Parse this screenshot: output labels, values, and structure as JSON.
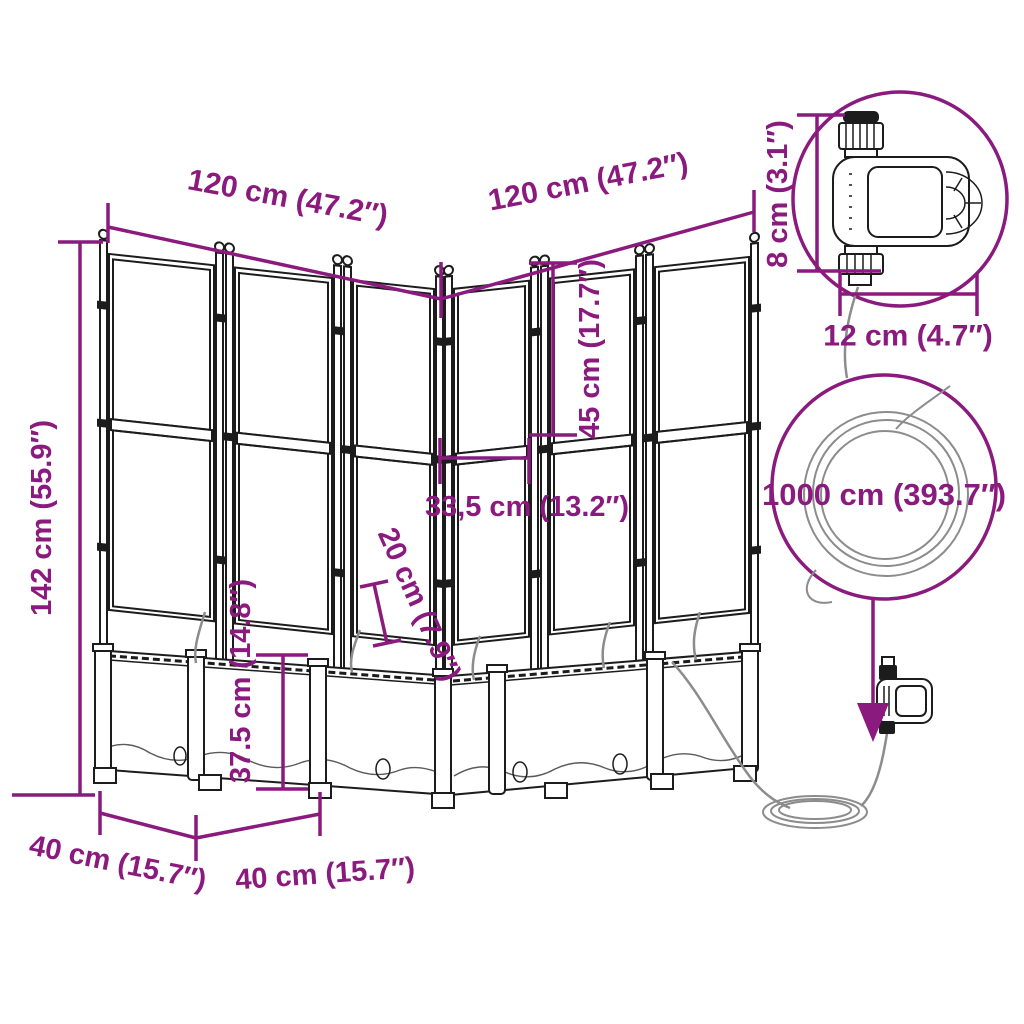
{
  "title": "Garden planter with trellis, drip irrigation set and water timer — dimension diagram",
  "colors": {
    "accent": "#8B1A7E",
    "line_art": "#1c1c1c",
    "hose": "#8c8c8c",
    "background": "#ffffff"
  },
  "labels": {
    "trellis_width_left": "120 cm (47.2″)",
    "trellis_width_right": "120 cm (47.2″)",
    "total_height": "142 cm (55.9″)",
    "upper_trellis_height": "45 cm (17.7″)",
    "panel_section_width": "33,5 cm (13.2″)",
    "planter_inner_depth": "20 cm (7.9″)",
    "planter_height": "37.5 cm (14.8″)",
    "planter_depth_left": "40 cm (15.7″)",
    "planter_depth_front": "40 cm (15.7″)",
    "hose_length": "1000 cm (393.7″)",
    "timer_height": "8 cm (3.1″)",
    "timer_width": "12 cm (4.7″)"
  }
}
